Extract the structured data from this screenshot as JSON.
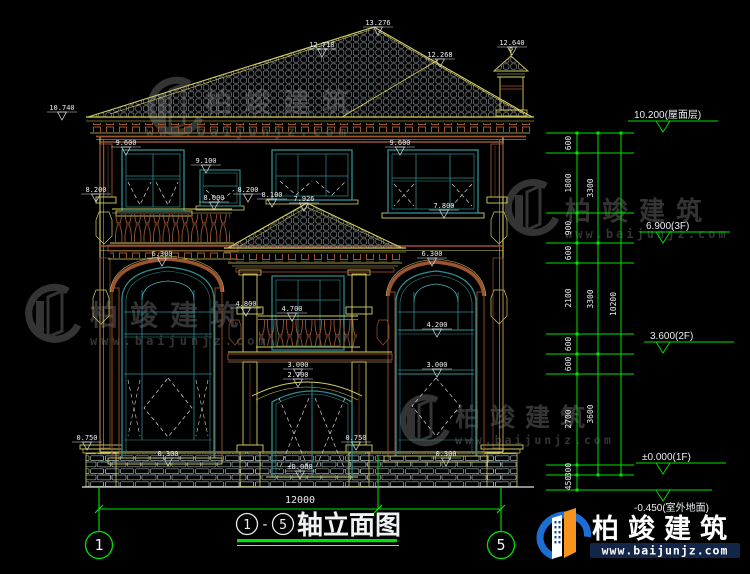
{
  "colors": {
    "background": "#000000",
    "cad_yellow": "#d4ce62",
    "cad_brown": "#9c5330",
    "cad_teal": "#2f8f8f",
    "axis_green": "#00e400",
    "dim_white": "#e9eef0",
    "watermark_gray": "#343434",
    "logo_blue": "#1c6ed2",
    "logo_orange": "#f7941d"
  },
  "dims": [
    "13.276",
    "12.718",
    "12.268",
    "12.640",
    "10.740",
    "9.600",
    "9.100",
    "9.600",
    "8.200",
    "8.000",
    "8.200",
    "8.100",
    "7.926",
    "7.800",
    "6.300",
    "6.300",
    "4.800",
    "4.700",
    "4.200",
    "3.000",
    "2.700",
    "3.000",
    "0.750",
    "0.750",
    "0.300",
    "0.300",
    "±0.000"
  ],
  "chain": {
    "col1": [
      "600",
      "1800",
      "900",
      "600",
      "2100",
      "600",
      "600",
      "2700",
      "300",
      "450"
    ],
    "col2": [
      "3300",
      "3300",
      "3600"
    ],
    "col3": [
      "10200"
    ]
  },
  "level_flags": [
    "10.200(屋面层)",
    "6.900(3F)",
    "3.600(2F)",
    "±0.000(1F)",
    "-0.450(室外地面)"
  ],
  "overall_width_dim": "12000",
  "axes": {
    "left": "1",
    "right": "5"
  },
  "title": {
    "axis_from": "1",
    "separator": "-",
    "axis_to": "5",
    "label": "轴立面图"
  },
  "watermark": {
    "brand": "柏竣建筑",
    "site": "www.baijunjz.com"
  },
  "logo": {
    "brand": "柏竣建筑",
    "site": "www.baijunjz.com"
  }
}
